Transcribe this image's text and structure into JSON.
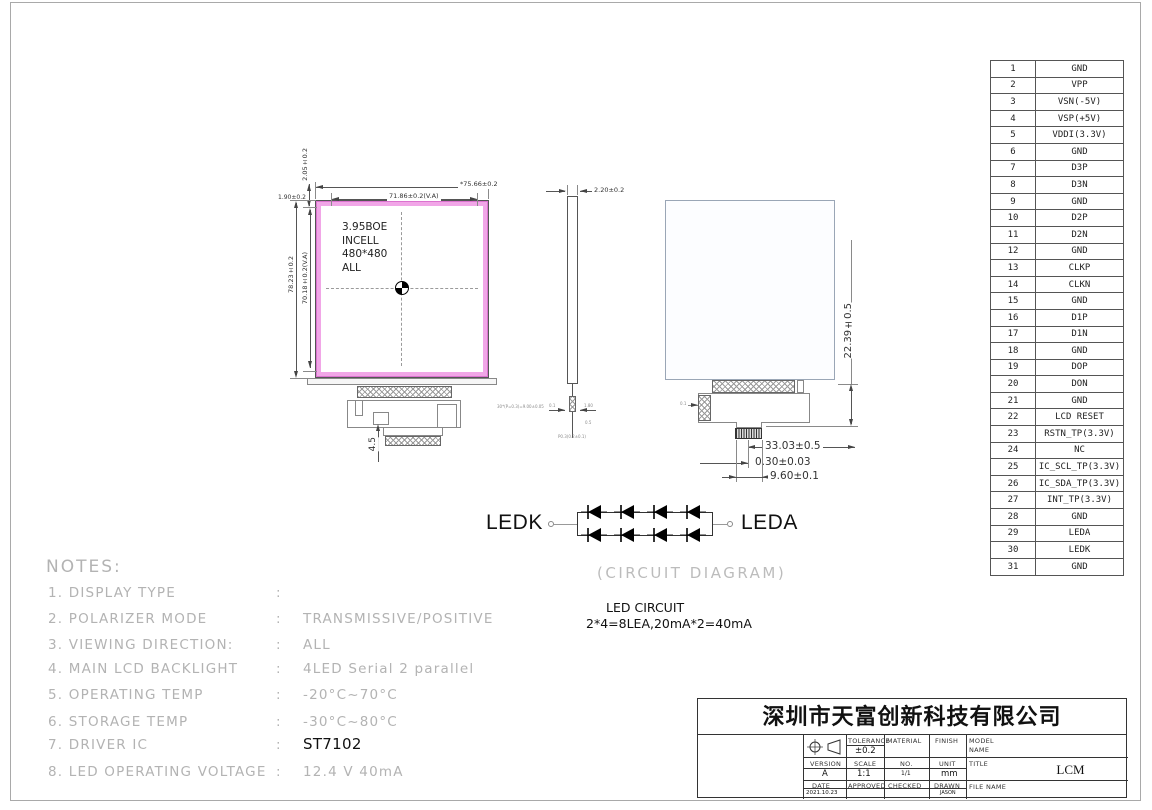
{
  "colors": {
    "bezel_pink": "#f1a6e7",
    "bezel_edge": "#db72cf",
    "note_gray": "#b3b3b3",
    "line": "#555555"
  },
  "front_view": {
    "panel_lines": [
      "3.95BOE",
      "INCELL",
      "480*480",
      "ALL"
    ],
    "dims": {
      "outer_width": "*75.66±0.2",
      "va_width": "71.86±0.2(V.A)",
      "outer_height": "78.23±0.2",
      "va_height": "70.18±0.2(V.A)",
      "top_margin": "2.05±0.2",
      "left_margin": "1.90±0.2",
      "tab_length": "4.5",
      "pitch_note": "30*(P=0.3)=9.00±0.05"
    }
  },
  "side_view": {
    "thickness": "2.20±0.2",
    "micro": {
      "a": "0.1",
      "b": "1.80",
      "c": "0.5",
      "d": "P0.3(0.2±0.1)"
    }
  },
  "back_view": {
    "fpc_length": "22.39±0.5",
    "dim_a": "33.03±0.5",
    "dim_b": "0.30±0.03",
    "dim_c": "9.60±0.1",
    "stiffener_note": "0.1"
  },
  "led_circuit": {
    "left_terminal": "LEDK",
    "right_terminal": "LEDA",
    "caption": "(CIRCUIT DIAGRAM)",
    "title": "LED CIRCUIT",
    "spec": "2*4=8LEA,20mA*2=40mA"
  },
  "notes": {
    "heading": "NOTES:",
    "items": [
      {
        "label": "1. DISPLAY TYPE",
        "sep": ":",
        "value": ""
      },
      {
        "label": "2. POLARIZER MODE",
        "sep": ":",
        "value": "TRANSMISSIVE/POSITIVE"
      },
      {
        "label": "3. VIEWING DIRECTION:",
        "sep": ":",
        "value": "ALL"
      },
      {
        "label": "4. MAIN LCD BACKLIGHT",
        "sep": ":",
        "value": "4LED Serial 2 parallel"
      },
      {
        "label": "5. OPERATING TEMP",
        "sep": ":",
        "value": "-20°C~70°C"
      },
      {
        "label": "6. STORAGE TEMP",
        "sep": ":",
        "value": "-30°C~80°C"
      },
      {
        "label": "7. DRIVER IC",
        "sep": ":",
        "value": "ST7102",
        "em": true
      },
      {
        "label": "8. LED OPERATING VOLTAGE",
        "sep": ":",
        "value": "12.4 V 40mA"
      }
    ]
  },
  "pin_table": {
    "pins": [
      {
        "no": "1",
        "name": "GND"
      },
      {
        "no": "2",
        "name": "VPP"
      },
      {
        "no": "3",
        "name": "VSN(-5V)"
      },
      {
        "no": "4",
        "name": "VSP(+5V)"
      },
      {
        "no": "5",
        "name": "VDDI(3.3V)"
      },
      {
        "no": "6",
        "name": "GND"
      },
      {
        "no": "7",
        "name": "D3P"
      },
      {
        "no": "8",
        "name": "D3N"
      },
      {
        "no": "9",
        "name": "GND"
      },
      {
        "no": "10",
        "name": "D2P"
      },
      {
        "no": "11",
        "name": "D2N"
      },
      {
        "no": "12",
        "name": "GND"
      },
      {
        "no": "13",
        "name": "CLKP"
      },
      {
        "no": "14",
        "name": "CLKN"
      },
      {
        "no": "15",
        "name": "GND"
      },
      {
        "no": "16",
        "name": "D1P"
      },
      {
        "no": "17",
        "name": "D1N"
      },
      {
        "no": "18",
        "name": "GND"
      },
      {
        "no": "19",
        "name": "DOP"
      },
      {
        "no": "20",
        "name": "DON"
      },
      {
        "no": "21",
        "name": "GND"
      },
      {
        "no": "22",
        "name": "LCD RESET"
      },
      {
        "no": "23",
        "name": "RSTN_TP(3.3V)"
      },
      {
        "no": "24",
        "name": "NC"
      },
      {
        "no": "25",
        "name": "IC_SCL_TP(3.3V)"
      },
      {
        "no": "26",
        "name": "IC_SDA_TP(3.3V)"
      },
      {
        "no": "27",
        "name": "INT_TP(3.3V)"
      },
      {
        "no": "28",
        "name": "GND"
      },
      {
        "no": "29",
        "name": "LEDA"
      },
      {
        "no": "30",
        "name": "LEDK"
      },
      {
        "no": "31",
        "name": "GND"
      }
    ]
  },
  "title_block": {
    "company": "深圳市天富创新科技有限公司",
    "tolerance_label": "TOLERANCE",
    "tolerance_value": "±0.2",
    "material_label": "MATERIAL",
    "finish_label": "FINISH",
    "model_name_label": "MODEL NAME",
    "version_label": "VERSION",
    "version_value": "A",
    "scale_label": "SCALE",
    "scale_value": "1:1",
    "no_label": "NO.",
    "no_value": "1/1",
    "unit_label": "UNIT",
    "unit_value": "mm",
    "title_label": "TITLE",
    "title_value": "LCM",
    "date_label": "DATE",
    "date_value": "2021.10.23",
    "approved_label": "APPROVED",
    "checked_label": "CHECKED",
    "drawn_label": "DRAWN",
    "drawn_value": "JASON",
    "file_name_label": "FILE NAME"
  }
}
